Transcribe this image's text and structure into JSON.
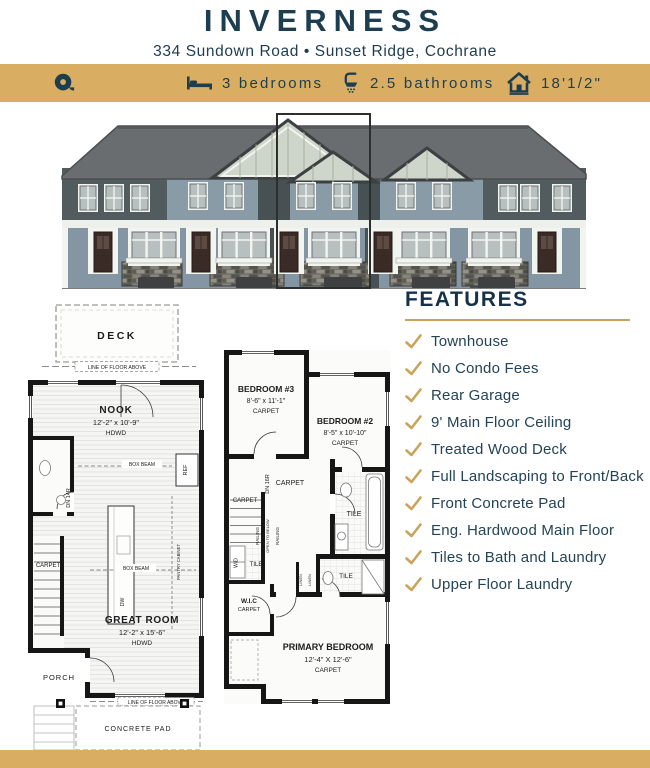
{
  "header": {
    "title": "INVERNESS",
    "address": "334 Sundown Road • Sunset Ridge, Cochrane"
  },
  "banner": {
    "bg_color": "#D9AE62",
    "items": [
      {
        "icon": "tape-measure-icon",
        "label": ""
      },
      {
        "icon": "bed-icon",
        "label": "3 bedrooms"
      },
      {
        "icon": "shower-icon",
        "label": "2.5 bathrooms"
      },
      {
        "icon": "house-width-icon",
        "label": "18'1/2\""
      }
    ]
  },
  "elevation": {
    "description": "street elevation of five-unit townhouse row",
    "highlighted_unit": "center unit outlined"
  },
  "features": {
    "heading": "FEATURES",
    "items": [
      "Townhouse",
      "No Condo Fees",
      "Rear Garage",
      "9' Main Floor Ceiling",
      "Treated Wood Deck",
      "Full Landscaping to Front/Back",
      "Front Concrete Pad",
      "Eng. Hardwood Main Floor",
      "Tiles to Bath and Laundry",
      "Upper Floor Laundry"
    ]
  },
  "floorplans": {
    "main": {
      "deck": "DECK",
      "line_of_floor_above": "LINE OF FLOOR ABOVE",
      "nook": {
        "name": "NOOK",
        "dims": "12'-2\" x 10'-9\"",
        "floor": "HDWD"
      },
      "great_room": {
        "name": "GREAT ROOM",
        "dims": "12'-2\" x 15'-6\"",
        "floor": "HDWD"
      },
      "porch": "PORCH",
      "concrete_pad": "CONCRETE PAD",
      "stair_carpet": "CARPET",
      "dn": "DN 14R",
      "box_beam": "BOX BEAM",
      "ref": "REF",
      "dw": "DW",
      "pantry": "PANTRY CABINET"
    },
    "upper": {
      "bedroom3": {
        "name": "BEDROOM #3",
        "dims": "8'-6\" x 11'-1\"",
        "floor": "CARPET"
      },
      "bedroom2": {
        "name": "BEDROOM #2",
        "dims": "8'-5\" x 10'-10\"",
        "floor": "CARPET"
      },
      "primary": {
        "name": "PRIMARY BEDROOM",
        "dims": "12'-4\" X 12'-6\"",
        "floor": "CARPET"
      },
      "hall_carpet": "CARPET",
      "stair_carpet": "CARPET",
      "dn": "DN 16R",
      "railing": "RAILING",
      "open_to_below": "OPEN TO BELOW",
      "tile_bath": "TILE",
      "tile_laundry": "TILE",
      "tile_ensuite": "TILE",
      "wd": "W/D",
      "wic": {
        "name": "W.I.C",
        "floor": "CARPET"
      },
      "linen": "LINEN"
    }
  },
  "colors": {
    "gold": "#D9AE62",
    "navy": "#1D3D50",
    "check_gold": "#C9A45A"
  }
}
